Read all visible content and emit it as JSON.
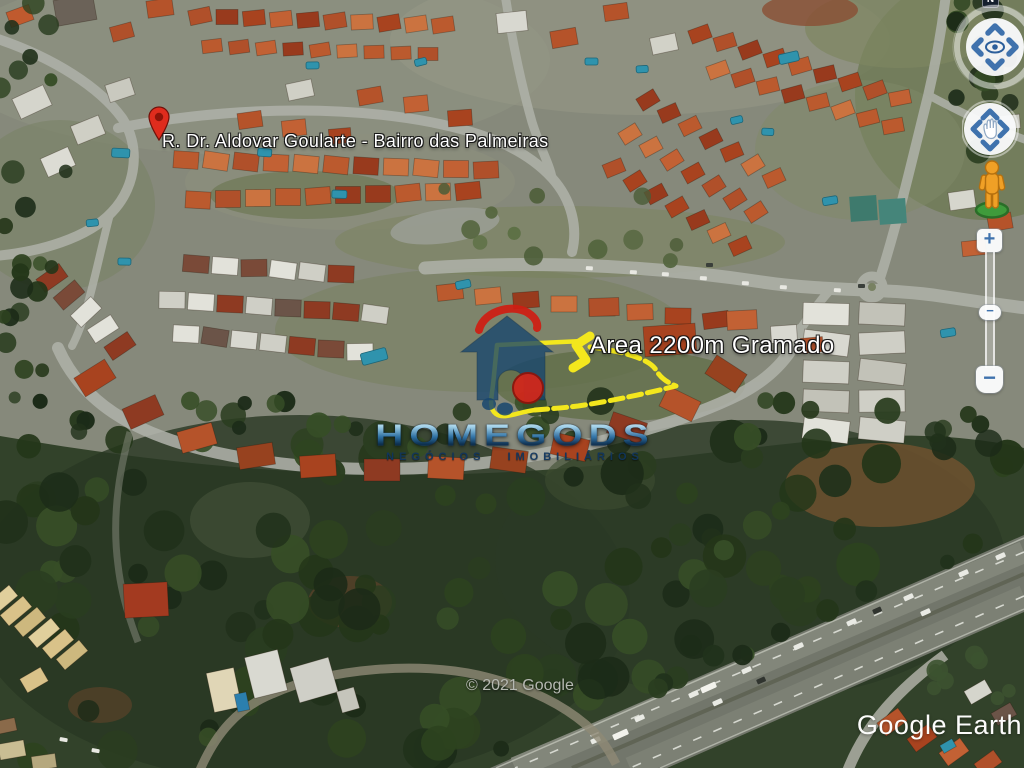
{
  "map": {
    "street_label": "R. Dr. Aldovar Goularte - Bairro das Palmeiras",
    "area_label": "Area 2200m Gramado",
    "copyright": "© 2021 Google",
    "branding": "Google Earth",
    "annotation_color": "#f3e71d",
    "pin_color": "#df2c1d"
  },
  "watermark": {
    "brand": "HOMEGODS",
    "tagline": "NEGÓCIOS IMOBILIÁRIOS",
    "colors": {
      "house_blue": "#17466e",
      "accent_red": "#cf1d12",
      "tagline_navy": "#10355e"
    }
  },
  "controls": {
    "compass_label": "N",
    "zoom_in_label": "+",
    "zoom_out_label": "−",
    "zoom_handle_label": "−"
  }
}
